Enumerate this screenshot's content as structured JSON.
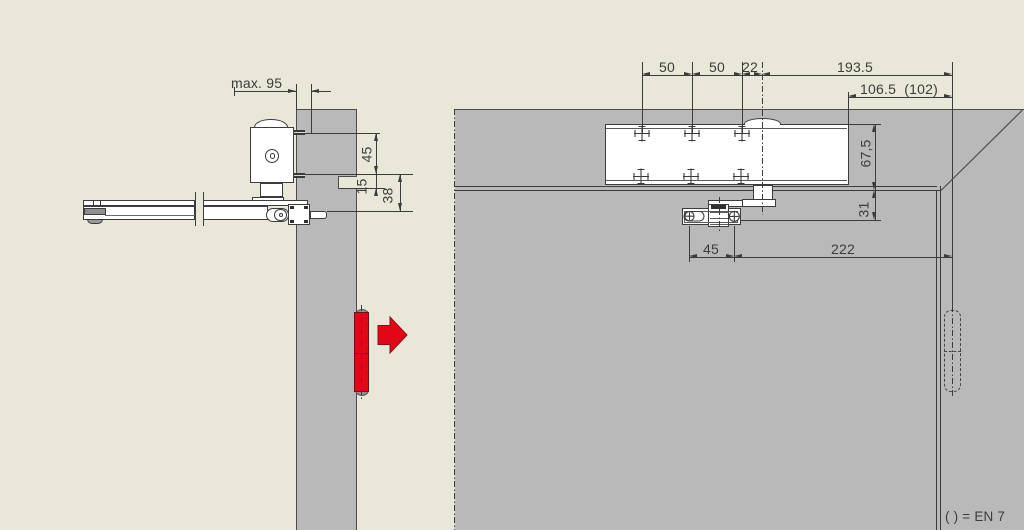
{
  "colors": {
    "background": "#e9e7d8",
    "wall": "#b9b9b9",
    "line": "#3c3c3c",
    "red": "#e30617",
    "red_dark": "#6e1212"
  },
  "left_view": {
    "dims": {
      "max_95": "max. 95",
      "v45": "45",
      "v15": "15",
      "v38": "38"
    }
  },
  "right_view": {
    "dims": {
      "h50a": "50",
      "h50b": "50",
      "h22": "22",
      "h193": "193.5",
      "h106": "106.5  (102)",
      "v67": "67,5",
      "v31": "31",
      "b45": "45",
      "b222": "222"
    }
  },
  "legend": {
    "note": "( ) = EN 7"
  }
}
